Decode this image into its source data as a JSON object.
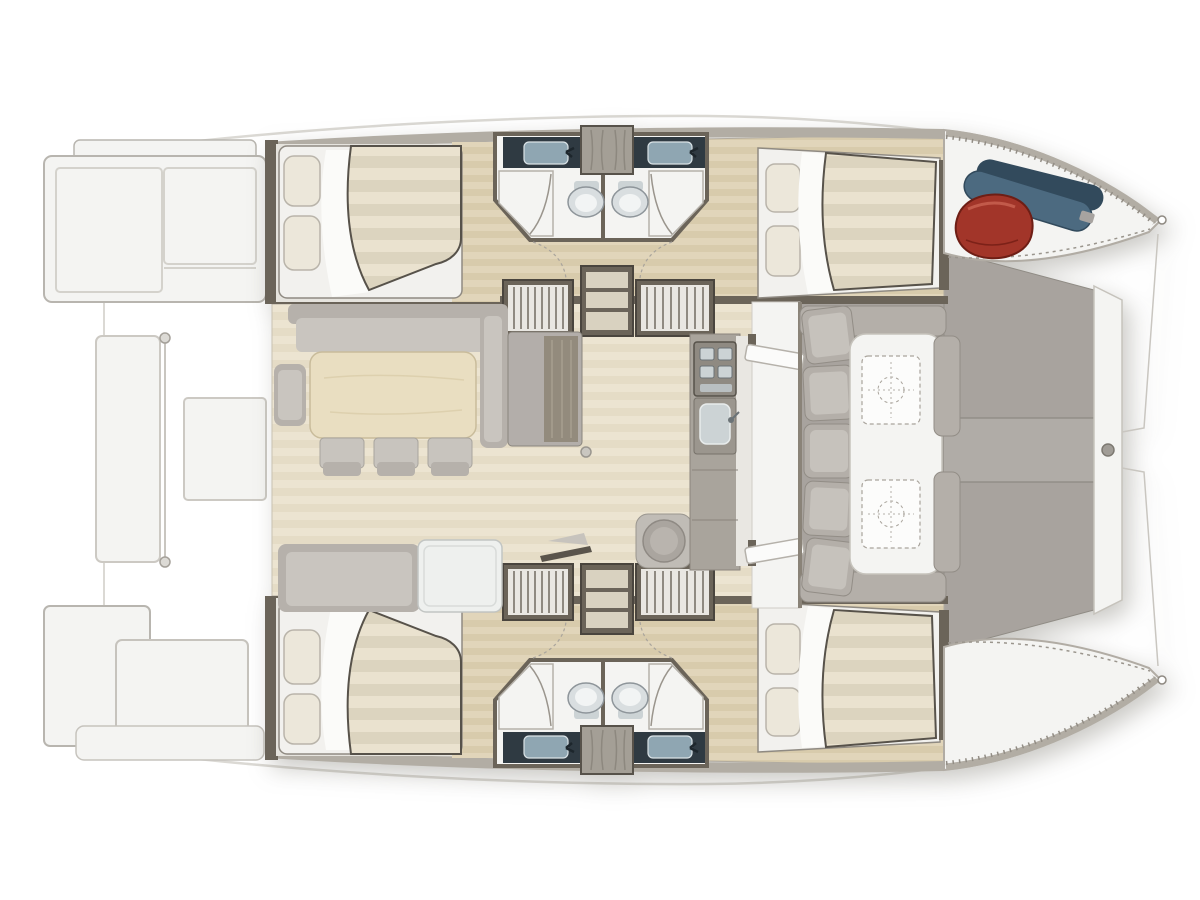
{
  "image": {
    "width": 1200,
    "height": 900,
    "viewBox": "0 0 1200 900",
    "background": "#ffffff"
  },
  "colors": {
    "bg": "#ffffff",
    "ghost": "#dbd9d4",
    "outline": "#b8b5af",
    "hullLight": "#f4f4f2",
    "deckBand": "#b2ada4",
    "deckGray": "#a8a39e",
    "deckGrayLight": "#b0aca7",
    "cushion": "#b4afa9",
    "cushionLight": "#c6c2bc",
    "bulkhead": "#6b6459",
    "woodHullA": "#e1d5ba",
    "woodHullB": "#d8cbac",
    "woodSaloonA": "#ece4d1",
    "woodSaloonB": "#e5dcc6",
    "mattressA": "#eae2cf",
    "mattressB": "#dcd4bf",
    "bedBase": "#f2f1ee",
    "sheet": "#fbfbf9",
    "pillow": "#ece7da",
    "sofa": "#b6b1ab",
    "sofaLight": "#c9c5bf",
    "tableWood": "#e9dec1",
    "chair": "#c8c4be",
    "whiteTable": "#eef0ee",
    "counter": "#2f3a42",
    "steel": "#8fa6b2",
    "basin": "#ccd3d5",
    "toilet": "#d9dee0",
    "stairLight": "#e9e7e2",
    "stairDark": "#8f8a81",
    "shelfWood": "#d9d2c0",
    "stool": "#b4afa9",
    "red": "#a23529",
    "redDark": "#6e1e15",
    "blue": "#4c6a80",
    "blueDark": "#324a5c",
    "stitch": "#928d85"
  },
  "plan": {
    "vessel": "catamaran-deck-plan",
    "orientation": "bow-right",
    "areas": [
      "aft-swim-platforms",
      "aft-deck",
      "saloon-dining-table-and-sofas",
      "galley-with-stove-and-sink",
      "storage-cabinet",
      "port-hull-aft-double-cabin",
      "port-hull-two-shower-rooms-with-wc",
      "port-hull-forward-double-cabin",
      "starboard-hull-mirrored-accommodation",
      "companionway-stairs",
      "forward-cockpit-lounge-with-twin-tables",
      "foredeck-sun-area",
      "bow-lockers-with-fender-and-lines"
    ],
    "counts": {
      "double_cabins": 4,
      "shower_rooms": 4,
      "toilets": 4,
      "sinks": 4,
      "companionway_stairs": 4,
      "dining_chairs": 3,
      "cockpit_tables": 2,
      "bow_gear": [
        "red-fender-bag",
        "blue-line-rolls"
      ]
    }
  }
}
